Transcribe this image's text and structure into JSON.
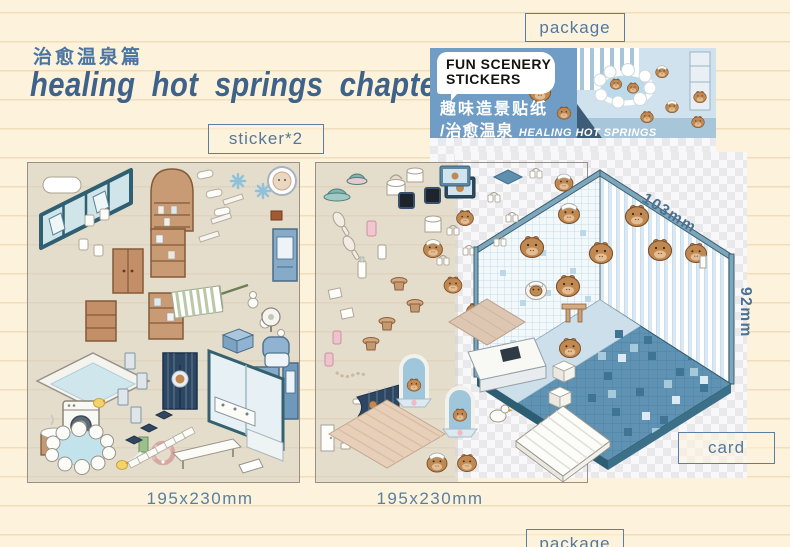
{
  "header": {
    "subtitle_cn": "治愈温泉篇",
    "title": "healing hot springs chapter"
  },
  "labels": {
    "package_top": "package",
    "sticker_count": "sticker*2",
    "card": "card",
    "package_bottom": "package"
  },
  "banner": {
    "brand_line1": "FUN SCENERY",
    "brand_line2": "STICKERS",
    "product_cn": "趣味造景贴纸",
    "series_cn": "/治愈温泉",
    "series_en": "HEALING HOT SPRINGS"
  },
  "sheets": [
    {
      "size": "195x230mm"
    },
    {
      "size": "195x230mm"
    }
  ],
  "card": {
    "width_label": "103mm",
    "height_label": "92mm"
  },
  "colors": {
    "page_bg": "#fdf3dc",
    "ruled_line": "#f1ddbb",
    "accent_blue": "#3e6289",
    "label_blue": "#54789c",
    "banner_blue": "#6f9dc5",
    "card_frame_teal": "#35616f",
    "floor_blue": "#6093b3",
    "capybara_brown": "#c08952"
  }
}
